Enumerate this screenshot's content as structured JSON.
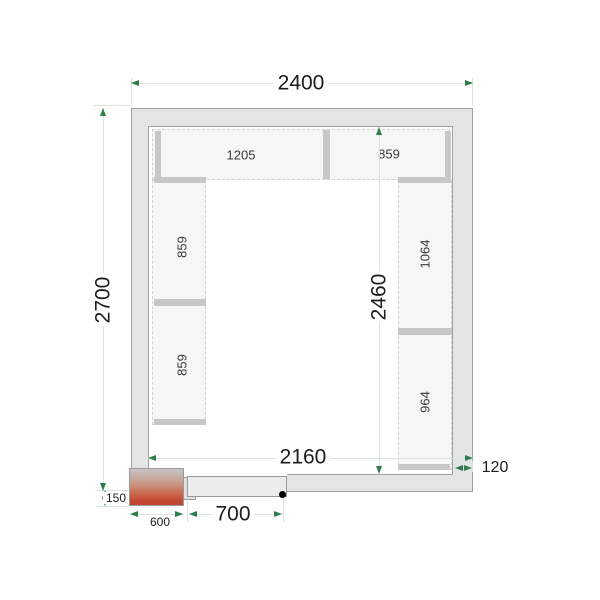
{
  "title": "Cold room floor plan",
  "dims": {
    "outer_width": "2400",
    "outer_depth": "2700",
    "inner_width": "2160",
    "inner_depth": "2460",
    "wall_thickness": "120",
    "door_width": "700",
    "door_zone_width": "600",
    "door_zone_depth": "150"
  },
  "shelves": {
    "top_left": "1205",
    "top_right": "859",
    "left_upper": "859",
    "left_lower": "859",
    "right_upper": "1064",
    "right_lower": "964"
  },
  "colors": {
    "wall_fill": "#e4e4e4",
    "shelf_fill": "#f6f6f6",
    "bar_fill": "#c7c7c7",
    "dim_line": "#d9e6de",
    "arrow_green": "#2f7d4b",
    "door_zone_red": "#c04432"
  }
}
